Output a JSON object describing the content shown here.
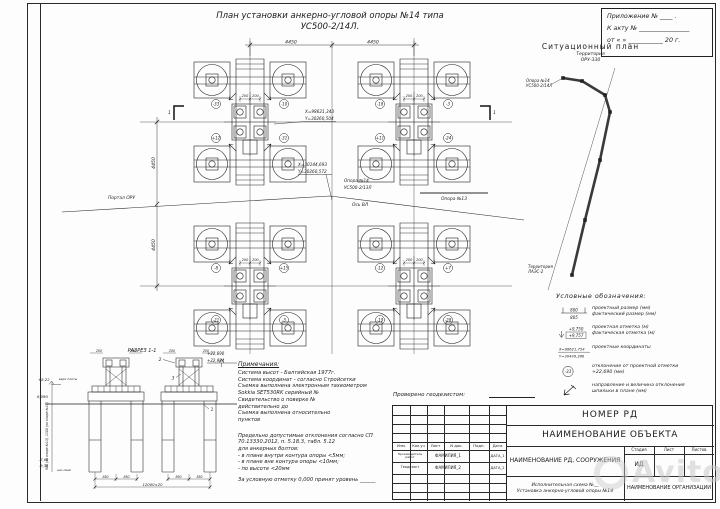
{
  "header": {
    "title_line1": "План установки  анкерно-угловой опоры №14 типа",
    "title_line2": "УС500-2/14Л."
  },
  "appendix": {
    "line1": "Приложение № ____ .",
    "line2": "К акту № ________________",
    "line3": "от  «     »  ___________ 20     г."
  },
  "situational": {
    "title": "Ситуационный план",
    "territory1_line1": "Территория",
    "territory1_line2": "ОРУ-330",
    "support_line1": "Опора №14",
    "support_line2": "УС500-2/14Л",
    "territory2_line1": "Территория",
    "territory2_line2": "ЛАЭС-2"
  },
  "legend": {
    "title": "Условные обозначения:",
    "item1_top": "800",
    "item1_bottom": "805",
    "item1_text1": "проектный размер (мм)",
    "item1_text2": "фактический размер (мм)",
    "item2_top": "+9,750",
    "item2_bottom": "+9,757",
    "item2_text1": "проектная отметка (м)",
    "item2_text2": "фактическая отметка (м)",
    "item3_top": "X=98621,754",
    "item3_bottom": "Y=30449,386",
    "item3_text1": "проектные координаты",
    "item4_sym": "-33",
    "item4_text1": "отклонение от проектной отметки",
    "item4_text2": "+22,690 (мм)",
    "item5_text1": "направление и величина отклонения",
    "item5_text2": "шпильки в плане (мм)"
  },
  "plan": {
    "dim_span": "4450",
    "dim_bolt": "200",
    "callout1_line1": "X=98621,343",
    "callout1_line2": "Y=30260,504",
    "callout2_line1": "X=30144,693",
    "callout2_line2": "Y=30260,572",
    "support_line1": "Опора №14",
    "support_line2": "УС500-2/13Л",
    "axis_label": "Ось ВЛ",
    "portal_label": "Портал ОРУ",
    "neighbor_label": "Опора №13",
    "section_mark": "1",
    "dev": {
      "c0": [
        "-33",
        "-10",
        "+12",
        "-31"
      ],
      "c1": [
        "-18",
        "-3",
        "+11",
        "-24"
      ],
      "c2": [
        "-8",
        "+15",
        "-21",
        "-5"
      ],
      "c3": [
        "-12",
        "+7",
        "-19",
        "-28"
      ]
    }
  },
  "section": {
    "title": "РАЗРЕЗ 1-1",
    "elev1": "+22,690",
    "elev2": "+22,984",
    "dim_200": "200",
    "elev_left_top": "+8,22",
    "elev_ground": "8,090",
    "elev_b1": "-7,80",
    "elev_b2": "-9,30",
    "label_top": "верх плиты",
    "label_bottom": "низ свай",
    "dim_rot": "900 (по опоре №13), 1100 (по опоре №14)",
    "dim_850": "850",
    "dim_total": "12000±20",
    "callout_1": "1",
    "callout_2": "2",
    "callout_3": "3"
  },
  "notes": {
    "title": "Примечания:",
    "lines": [
      "Система высот - Балтийская 1977г.",
      "Система координат - согласно Стройсетки",
      "Съемка выполнена электронным тахеометром",
      "Sokkia SET530RK серийный №",
      "Свидетельство о поверке №",
      "действительно до",
      "Съемка выполнена относительно",
      "пунктов"
    ],
    "lines2": [
      "Предельно допустимые отклонения согласно СП",
      "70.13330.2012, п. 5.18.3, табл. 5.12",
      "для анкерных болтов:",
      "- в плане внутри контура опоры <5мм;",
      "- в плане вне контура опоры <10мм;",
      "- по высоте <20мм",
      "За условную отметку 0,000 принят уровень ______"
    ]
  },
  "titleblock": {
    "checked": "Проверено геодезистом:",
    "doc_number": "НОМЕР РД",
    "object_name": "НАИМЕНОВАНИЕ ОБЪЕКТА",
    "rd_name": "НАИМЕНОВАНИЕ РД, СООРУЖЕНИЯ",
    "col_stage": "Стадия",
    "col_sheet": "Лист",
    "col_sheets": "Листов",
    "stage_value": "ИД",
    "scheme_line1": "Исполнительная схема №__",
    "scheme_line2": "Установка  анкерно-угловой  опоры  №14",
    "org": "НАИМЕНОВАНИЕ ОРГАНИЗАЦИИ",
    "h1": "Изм.",
    "h2": "Кол.уч",
    "h3": "Лист",
    "h4": "N док.",
    "h5": "Подп.",
    "h6": "Дата",
    "row1_role": "Производитель работ",
    "row1_name": "ФАМИЛИЯ_1",
    "row1_date": "ДАТА_1",
    "row2_role": "Геодезист",
    "row2_name": "ФАМИЛИЯ_2",
    "row2_date": "ДАТА_2"
  },
  "watermark": {
    "text": "Avito"
  }
}
